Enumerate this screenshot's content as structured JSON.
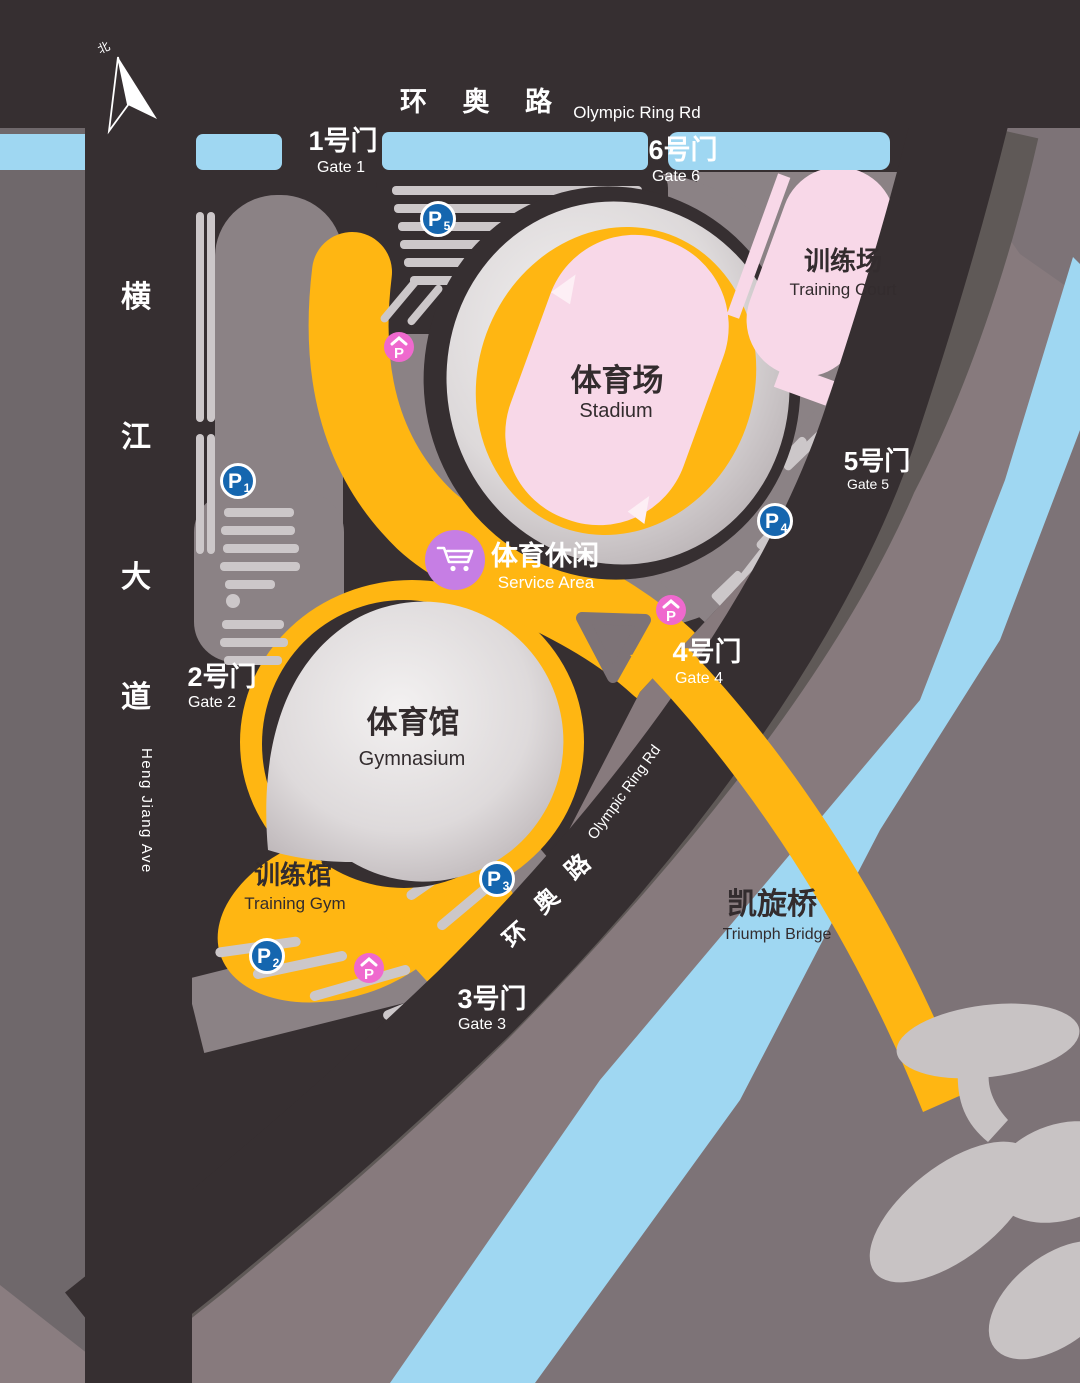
{
  "north": {
    "label": "北"
  },
  "roads": {
    "olympic_top": {
      "zh": "环 奥 路",
      "en": "Olympic Ring Rd"
    },
    "hengjiang": {
      "chars": [
        "横",
        "江",
        "大",
        "道"
      ],
      "en": "Heng Jiang  Ave"
    },
    "olympic_diag": {
      "chars": [
        "环",
        "奥",
        "路"
      ],
      "en": "Olympic Ring Rd"
    }
  },
  "gates": [
    {
      "zh": "1号门",
      "en": "Gate 1"
    },
    {
      "zh": "2号门",
      "en": "Gate 2"
    },
    {
      "zh": "3号门",
      "en": "Gate 3"
    },
    {
      "zh": "4号门",
      "en": "Gate 4"
    },
    {
      "zh": "5号门",
      "en": "Gate 5"
    },
    {
      "zh": "6号门",
      "en": "Gate 6"
    }
  ],
  "venues": {
    "stadium": {
      "zh": "体育场",
      "en": "Stadium"
    },
    "gymnasium": {
      "zh": "体育馆",
      "en": "Gymnasium"
    },
    "training_court": {
      "zh": "训练场",
      "en": "Training Court"
    },
    "training_gym": {
      "zh": "训练馆",
      "en": "Training Gym"
    },
    "service_area": {
      "zh": "体育休闲",
      "en": "Service Area"
    },
    "bridge": {
      "zh": "凯旋桥",
      "en": "Triumph Bridge"
    }
  },
  "parking": {
    "blue": [
      {
        "letter": "P",
        "num": "1"
      },
      {
        "letter": "P",
        "num": "2"
      },
      {
        "letter": "P",
        "num": "3"
      },
      {
        "letter": "P",
        "num": "4"
      },
      {
        "letter": "P",
        "num": "5"
      }
    ],
    "pink": {
      "letter": "P"
    }
  },
  "colors": {
    "path_yellow": "#FFB612",
    "water_blue": "#9FD7F2",
    "venue_pink": "#F8D8E8",
    "road_dark": "#362F31",
    "block_grey": "#7D7377",
    "parking_blue": "#1566AF",
    "parking_pink": "#EF69CE",
    "service_purple": "#C67EE4"
  }
}
